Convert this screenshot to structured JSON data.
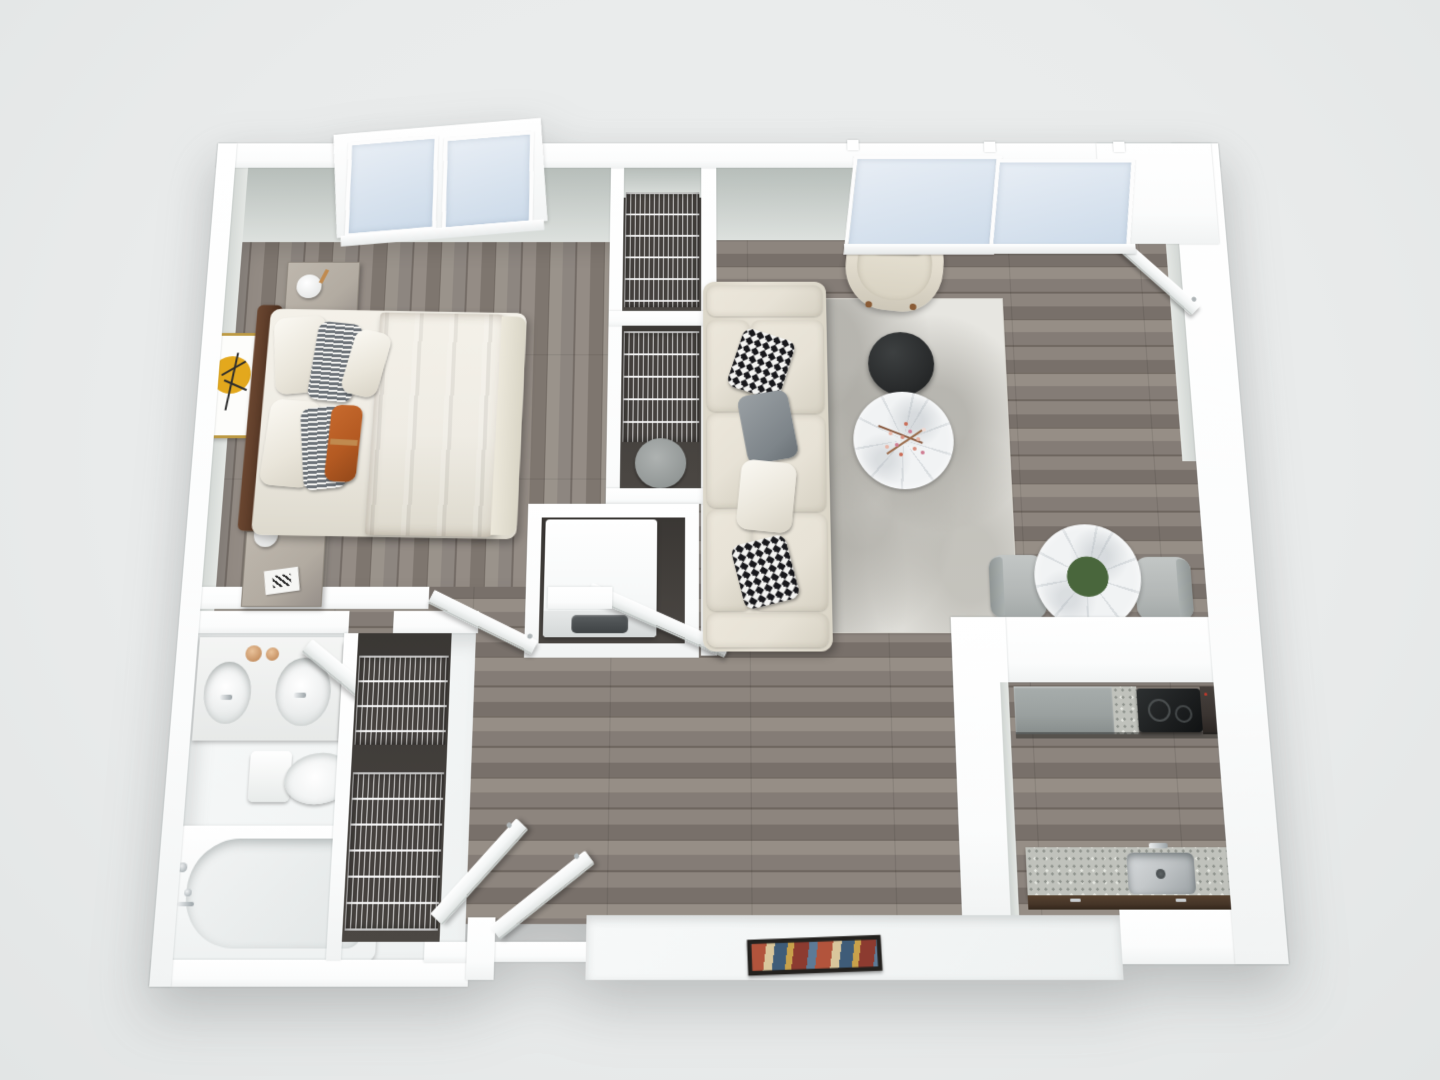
{
  "title": "3d-floor-plan-one-bedroom-apartment",
  "canvas": {
    "width": 1440,
    "height": 1080,
    "background": "#e9ebeb"
  },
  "scene": {
    "type": "3d-floor-plan",
    "view": "top-down-dollhouse",
    "unit": "one-bedroom-apartment",
    "rooms": [
      {
        "id": "bedroom",
        "position": "top-left",
        "items": [
          "double-bed",
          "dark-brown-headboard",
          "brown-duvet",
          "white-sheets",
          "white-pillows",
          "striped-pillows",
          "rust-lumbar-pillow-with-brass-band",
          "nightstand-top",
          "nightstand-bottom",
          "sphere-table-lamp-top",
          "sphere-table-lamp-bottom",
          "book-decor",
          "wall-art-yellow-circle-tree",
          "tilted-window-pair",
          "open-door"
        ]
      },
      {
        "id": "closet-upper",
        "position": "center-top",
        "items": [
          "wire-shelving"
        ]
      },
      {
        "id": "closet-middle",
        "position": "center",
        "items": [
          "wire-shelving",
          "small-round-gray-table"
        ]
      },
      {
        "id": "laundry-closet",
        "position": "center",
        "items": [
          "washer-dryer-unit",
          "open-door"
        ]
      },
      {
        "id": "living-room",
        "position": "top-right",
        "items": [
          "cream-sofa",
          "houndstooth-pillow-top",
          "houndstooth-pillow-bottom",
          "gray-pillows",
          "distressed-gray-rug",
          "black-round-coffee-table",
          "marble-round-coffee-table",
          "dried-flower-decor",
          "cream-armchair",
          "houndstooth-accent-pillow",
          "sliding-glass-window-panels"
        ]
      },
      {
        "id": "dining-nook",
        "position": "right",
        "items": [
          "round-marble-dining-table",
          "pink-rose-bouquet",
          "gray-dining-chair-left",
          "gray-dining-chair-right"
        ]
      },
      {
        "id": "entry",
        "position": "right",
        "items": [
          "open-entry-door",
          "vestibule-wall"
        ]
      },
      {
        "id": "kitchen",
        "position": "bottom-right",
        "items": [
          "gray-base-cabinets",
          "granite-countertop-top-run",
          "black-cooktop",
          "dark-refrigerator",
          "granite-countertop-sink-run",
          "stainless-steel-sink",
          "chrome-faucet",
          "dark-wood-cabinet-fronts"
        ]
      },
      {
        "id": "bathroom",
        "position": "bottom-left",
        "items": [
          "double-sink-vanity",
          "oval-sink-left",
          "oval-sink-right",
          "gold-accessory-dishes",
          "chrome-faucets",
          "dark-wood-side-cabinet",
          "toilet",
          "bathtub",
          "shower-fixtures",
          "open-door"
        ]
      },
      {
        "id": "hall-closet",
        "position": "bottom-center",
        "items": [
          "wire-shelving-upper",
          "wire-shelving-lower",
          "tilted-bifold-doors"
        ]
      },
      {
        "id": "landing",
        "position": "bottom-center",
        "items": [
          "white-floor-slab",
          "multicolor-doormat"
        ]
      }
    ]
  },
  "palette": {
    "bg": "#e9ebeb",
    "wall": "#ffffff",
    "face_dark": "#b6bdb9",
    "face_light": "#dde1de",
    "wood": "#847c76",
    "wood_dark": "#6e665f",
    "wood_light": "#968e86",
    "closet_floor": "#45413e",
    "bath_floor": "#f5f7f7",
    "glass_a": "#e8eef5",
    "glass_b": "#ccdae9",
    "rug": "#e7e6e1",
    "sofa": "#e7e2d6",
    "hounds_dark": "#17171b",
    "table_black": "#2a2c2d",
    "marble": "#f1f3f4",
    "chair": "#b3b7b6",
    "headboard": "#5a3a27",
    "duvet": "#a68c76",
    "sheet": "#efece4",
    "stripe": "#6d7379",
    "rust": "#b45a22",
    "brass": "#c08a4f",
    "nightstand": "#b2aba1",
    "art_gold": "#bd9a43",
    "art_yellow": "#e3a81d",
    "granite": "#c0c2bc",
    "granite_dot": "#8e928c",
    "cabinet_gray": "#9aa09f",
    "cooktop": "#1c1e1f",
    "fridge": "#3a3431",
    "steel": "#c3c7c9",
    "wood_cabinet": "#463528",
    "mat_red": "#b2543c",
    "mat_blue": "#3f5c78",
    "mat_tan": "#d9c69c",
    "mat_gold": "#c8a14b",
    "flower_pink": "#c2527f",
    "flower_pink_dark": "#a83d68",
    "leaf_green": "#49663c",
    "chrome": "#c9cdd0"
  }
}
